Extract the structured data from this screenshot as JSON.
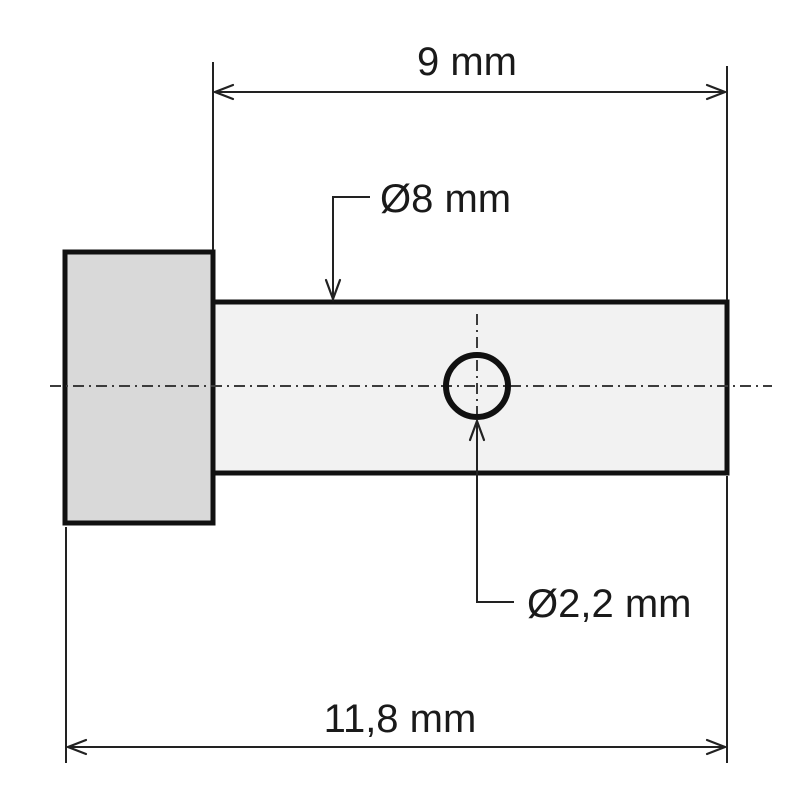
{
  "drawing": {
    "kind": "technical-part-drawing",
    "labels": {
      "top_width": "9 mm",
      "shaft_diameter": "Ø8 mm",
      "hole_diameter": "Ø2,2 mm",
      "overall_length": "11,8 mm"
    },
    "colors": {
      "background": "#ffffff",
      "outline": "#111111",
      "head_fill": "#d9d9d9",
      "shaft_fill": "#f2f2f2",
      "centerline": "#3c3c3c",
      "text": "#1a1a1a"
    }
  }
}
